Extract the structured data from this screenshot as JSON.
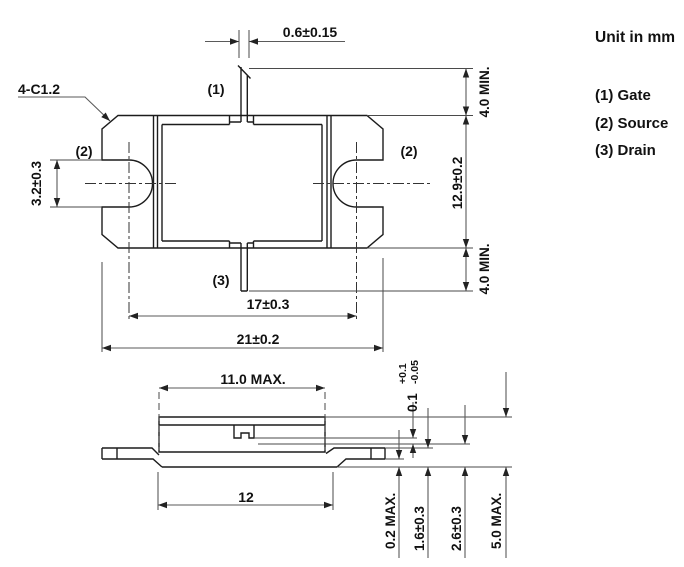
{
  "title": "Unit in mm",
  "legend": {
    "gate": "(1) Gate",
    "source": "(2) Source",
    "drain": "(3) Drain"
  },
  "labels": {
    "chamfer": "4-C1.2",
    "gate_pin": "(1)",
    "source_pin_left": "(2)",
    "source_pin_right": "(2)",
    "drain_pin": "(3)"
  },
  "dimensions": {
    "gate_lead_width": "0.6±0.15",
    "gate_lead_length_min": "4.0 MIN.",
    "body_depth": "12.9±0.2",
    "drain_lead_length_min": "4.0 MIN.",
    "mounting_slot_width": "3.2±0.3",
    "mounting_hole_pitch": "17±0.3",
    "flange_length": "21±0.2",
    "cap_length_max": "11.0 MAX.",
    "flange_bottom_length": "12",
    "lead_step_value": "0.1",
    "lead_step_tol_plus": "+0.1",
    "lead_step_tol_minus": "-0.05",
    "lead_standoff_max": "0.2 MAX.",
    "lead_height": "1.6±0.3",
    "seating_plane_height": "2.6±0.3",
    "overall_height_max": "5.0 MAX."
  }
}
